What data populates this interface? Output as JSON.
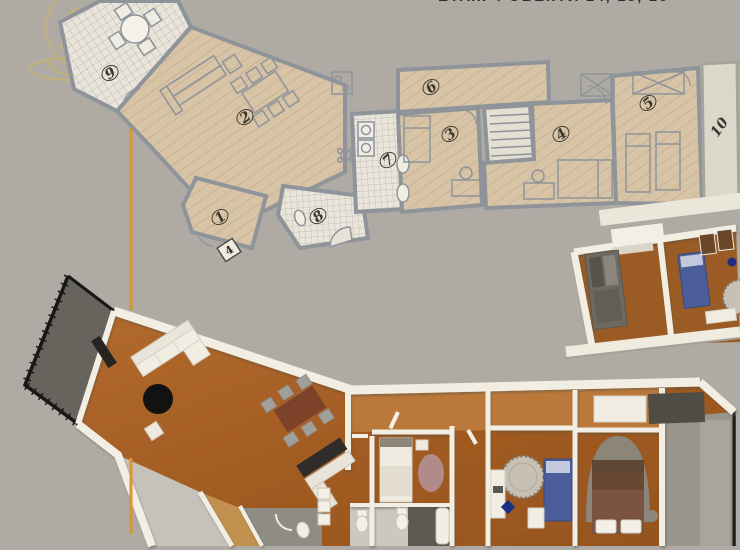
{
  "caption": {
    "text": "ЕТАЖ 4  ОБЕКТИ 14, 15, 16"
  },
  "watermark": {
    "icon": "house-location-pin-logo"
  },
  "plan2d": {
    "apartment_number_plate": "4",
    "rooms": {
      "r1": "1",
      "r2": "2",
      "r3": "3",
      "r4": "4",
      "r5": "5",
      "r6": "6",
      "r7": "7",
      "r8": "8",
      "r9": "9",
      "r10": "10"
    }
  },
  "colors": {
    "background": "#afaba4",
    "accent_line": "#d9952f",
    "logo_gold": "#cdb55e",
    "wall_2d": "#8e949a",
    "floor_2d": "#d7c3a6",
    "tile_2d": "#e9e5db",
    "balcony_2d": "#dcd7cb",
    "wall_3d": "#f2eee4",
    "floor_3d": "#a9622a",
    "balcony_rail": "#171717",
    "balcony_floor_3d": "#67635d",
    "rug_black": "#121212",
    "rug_pink": "#b18a8a",
    "rug_alphabet": "#c9c0b5",
    "bed_blue": "#4b5d9b",
    "arch_gray": "#8c8579",
    "kitchen_dark": "#2e2d2b",
    "table_brown": "#7c422a"
  }
}
